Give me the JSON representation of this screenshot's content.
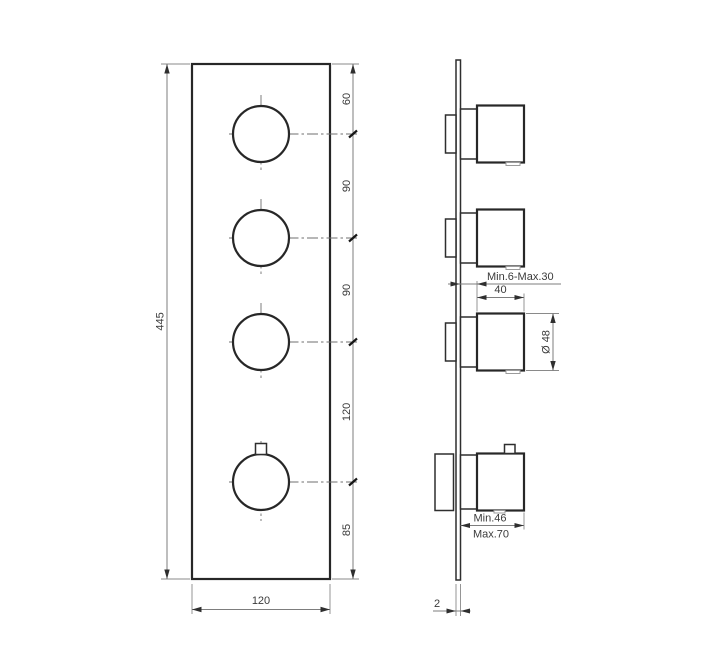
{
  "front_view": {
    "total_height": "445",
    "plate_width": "120",
    "spacings": [
      "60",
      "90",
      "90",
      "120",
      "85"
    ]
  },
  "side_view": {
    "depth_adjust_range": "Min.6-Max.30",
    "handle_depth": "40",
    "handle_diameter": "Ø 48",
    "protrusion_min": "Min.46",
    "protrusion_max": "Max.70",
    "plate_thickness": "2"
  }
}
